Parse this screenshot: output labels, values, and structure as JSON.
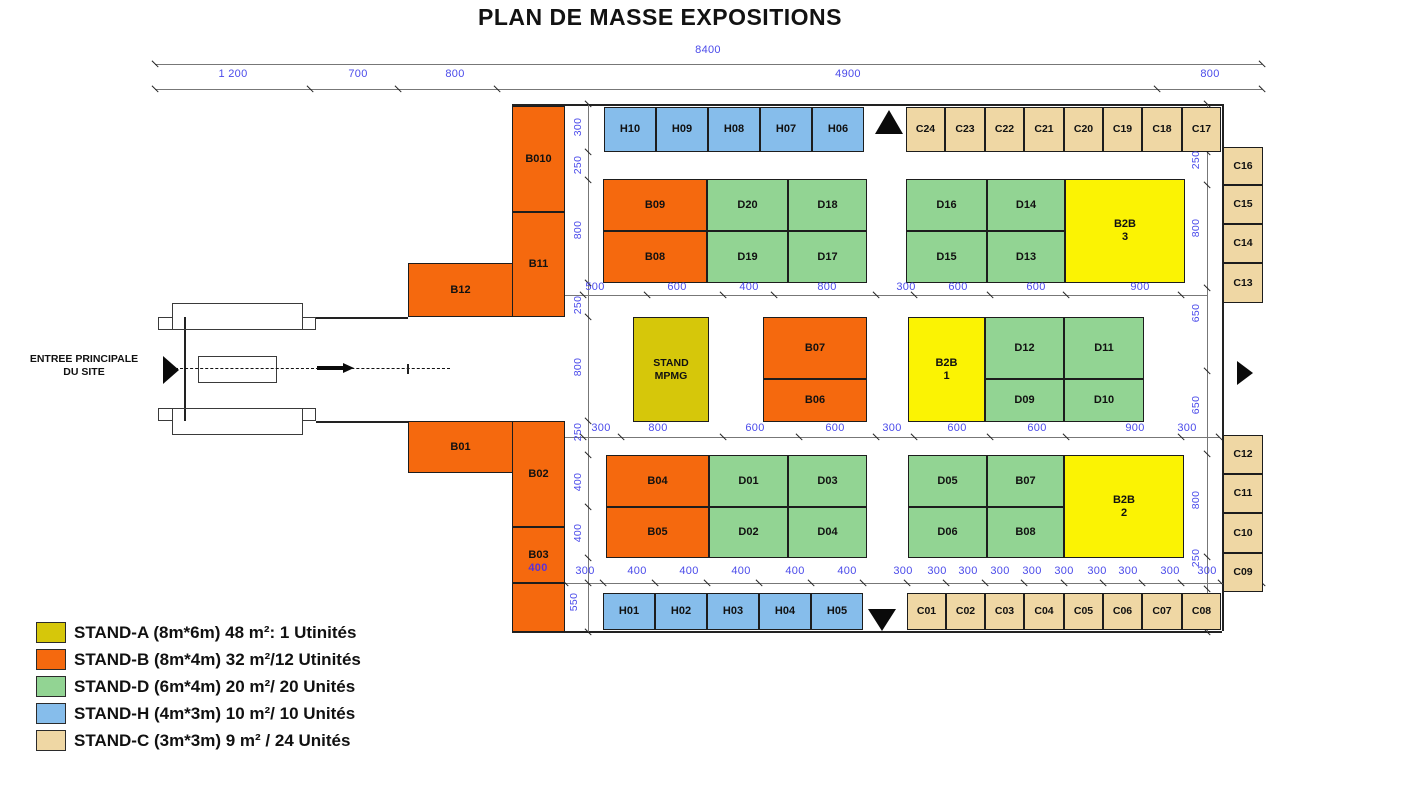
{
  "title": "PLAN DE MASSE EXPOSITIONS",
  "entrance": {
    "line1": "ENTREE PRINCIPALE",
    "line2": "DU SITE"
  },
  "colors": {
    "stand_a_olive": "#D6C70A",
    "stand_b_orange": "#F5690E",
    "stand_d_green": "#92D493",
    "stand_h_blue": "#86BDEB",
    "stand_c_tan": "#EFD7A4",
    "b2b_yellow": "#FBF303",
    "dim_text_blue": "#4B4BEA",
    "dim_text_purple": "#5A31D8",
    "line_dark": "#222222"
  },
  "legend": [
    {
      "type": "a",
      "text": "STAND-A (8m*6m) 48 m²: 1 Utinités"
    },
    {
      "type": "b",
      "text": "STAND-B (8m*4m) 32 m²/12 Utinités"
    },
    {
      "type": "d",
      "text": "STAND-D (6m*4m) 20 m²/ 20 Unités"
    },
    {
      "type": "h",
      "text": "STAND-H (4m*3m) 10 m²/ 10 Unités"
    },
    {
      "type": "c",
      "text": "STAND-C (3m*3m) 9 m² / 24 Unités"
    }
  ],
  "stands": [
    {
      "id": "B010",
      "t": "b",
      "x": 512,
      "y": 106,
      "w": 53,
      "h": 106
    },
    {
      "id": "B11",
      "t": "b",
      "x": 512,
      "y": 212,
      "w": 53,
      "h": 105
    },
    {
      "id": "B12",
      "t": "b",
      "x": 408,
      "y": 263,
      "w": 105,
      "h": 54
    },
    {
      "id": "B01",
      "t": "b",
      "x": 408,
      "y": 421,
      "w": 105,
      "h": 52
    },
    {
      "id": "B02",
      "t": "b",
      "x": 512,
      "y": 421,
      "w": 53,
      "h": 106
    },
    {
      "id": "B03",
      "t": "b",
      "x": 512,
      "y": 527,
      "w": 53,
      "h": 56
    },
    {
      "id": "",
      "n": "b-annex",
      "t": "b",
      "x": 512,
      "y": 583,
      "w": 53,
      "h": 49
    },
    {
      "id": "H10",
      "t": "h",
      "x": 604,
      "y": 107,
      "w": 52,
      "h": 45
    },
    {
      "id": "H09",
      "t": "h",
      "x": 656,
      "y": 107,
      "w": 52,
      "h": 45
    },
    {
      "id": "H08",
      "t": "h",
      "x": 708,
      "y": 107,
      "w": 52,
      "h": 45
    },
    {
      "id": "H07",
      "t": "h",
      "x": 760,
      "y": 107,
      "w": 52,
      "h": 45
    },
    {
      "id": "H06",
      "t": "h",
      "x": 812,
      "y": 107,
      "w": 52,
      "h": 45
    },
    {
      "id": "C24",
      "t": "c",
      "x": 906,
      "y": 107,
      "w": 39,
      "h": 45,
      "fs": 10.5
    },
    {
      "id": "C23",
      "t": "c",
      "x": 945,
      "y": 107,
      "w": 40,
      "h": 45,
      "fs": 10.5
    },
    {
      "id": "C22",
      "t": "c",
      "x": 985,
      "y": 107,
      "w": 39,
      "h": 45,
      "fs": 10.5
    },
    {
      "id": "C21",
      "t": "c",
      "x": 1024,
      "y": 107,
      "w": 40,
      "h": 45,
      "fs": 10.5
    },
    {
      "id": "C20",
      "t": "c",
      "x": 1064,
      "y": 107,
      "w": 39,
      "h": 45,
      "fs": 10.5
    },
    {
      "id": "C19",
      "t": "c",
      "x": 1103,
      "y": 107,
      "w": 39,
      "h": 45,
      "fs": 10.5
    },
    {
      "id": "C18",
      "t": "c",
      "x": 1142,
      "y": 107,
      "w": 40,
      "h": 45,
      "fs": 10.5
    },
    {
      "id": "C17",
      "t": "c",
      "x": 1182,
      "y": 107,
      "w": 39,
      "h": 45,
      "fs": 10.5
    },
    {
      "id": "B09",
      "t": "b",
      "x": 603,
      "y": 179,
      "w": 104,
      "h": 52
    },
    {
      "id": "B08",
      "t": "b",
      "x": 603,
      "y": 231,
      "w": 104,
      "h": 52
    },
    {
      "id": "D20",
      "t": "d",
      "x": 707,
      "y": 179,
      "w": 81,
      "h": 52
    },
    {
      "id": "D18",
      "t": "d",
      "x": 788,
      "y": 179,
      "w": 79,
      "h": 52
    },
    {
      "id": "D19",
      "t": "d",
      "x": 707,
      "y": 231,
      "w": 81,
      "h": 52
    },
    {
      "id": "D17",
      "t": "d",
      "x": 788,
      "y": 231,
      "w": 79,
      "h": 52
    },
    {
      "id": "D16",
      "t": "d",
      "x": 906,
      "y": 179,
      "w": 81,
      "h": 52
    },
    {
      "id": "D14",
      "t": "d",
      "x": 987,
      "y": 179,
      "w": 78,
      "h": 52
    },
    {
      "id": "D15",
      "t": "d",
      "x": 906,
      "y": 231,
      "w": 81,
      "h": 52
    },
    {
      "id": "D13",
      "t": "d",
      "x": 987,
      "y": 231,
      "w": 78,
      "h": 52
    },
    {
      "id": "B2B",
      "id2": "3",
      "n": "b2b-3",
      "t": "y",
      "x": 1065,
      "y": 179,
      "w": 120,
      "h": 104
    },
    {
      "id": "STAND",
      "id2": "MPMG",
      "n": "mpmg",
      "t": "a",
      "x": 633,
      "y": 317,
      "w": 76,
      "h": 105,
      "fs": 10.5
    },
    {
      "id": "B07",
      "t": "b",
      "x": 763,
      "y": 317,
      "w": 104,
      "h": 62
    },
    {
      "id": "B06",
      "t": "b",
      "x": 763,
      "y": 379,
      "w": 104,
      "h": 43
    },
    {
      "id": "B2B",
      "id2": "1",
      "n": "b2b-1",
      "t": "y",
      "x": 908,
      "y": 317,
      "w": 77,
      "h": 105
    },
    {
      "id": "D12",
      "t": "d",
      "x": 985,
      "y": 317,
      "w": 79,
      "h": 62
    },
    {
      "id": "D11",
      "t": "d",
      "x": 1064,
      "y": 317,
      "w": 80,
      "h": 62
    },
    {
      "id": "D09",
      "t": "d",
      "x": 985,
      "y": 379,
      "w": 79,
      "h": 43
    },
    {
      "id": "D10",
      "t": "d",
      "x": 1064,
      "y": 379,
      "w": 80,
      "h": 43
    },
    {
      "id": "B04",
      "t": "b",
      "x": 606,
      "y": 455,
      "w": 103,
      "h": 52
    },
    {
      "id": "B05",
      "t": "b",
      "x": 606,
      "y": 507,
      "w": 103,
      "h": 51
    },
    {
      "id": "D01",
      "t": "d",
      "x": 709,
      "y": 455,
      "w": 79,
      "h": 52
    },
    {
      "id": "D03",
      "t": "d",
      "x": 788,
      "y": 455,
      "w": 79,
      "h": 52
    },
    {
      "id": "D02",
      "t": "d",
      "x": 709,
      "y": 507,
      "w": 79,
      "h": 51
    },
    {
      "id": "D04",
      "t": "d",
      "x": 788,
      "y": 507,
      "w": 79,
      "h": 51
    },
    {
      "id": "D05",
      "t": "d",
      "x": 908,
      "y": 455,
      "w": 79,
      "h": 52
    },
    {
      "id": "B07",
      "n": "b07-d",
      "t": "d",
      "x": 987,
      "y": 455,
      "w": 77,
      "h": 52
    },
    {
      "id": "D06",
      "t": "d",
      "x": 908,
      "y": 507,
      "w": 79,
      "h": 51
    },
    {
      "id": "B08",
      "n": "b08-d",
      "t": "d",
      "x": 987,
      "y": 507,
      "w": 77,
      "h": 51
    },
    {
      "id": "B2B",
      "id2": "2",
      "n": "b2b-2",
      "t": "y",
      "x": 1064,
      "y": 455,
      "w": 120,
      "h": 103
    },
    {
      "id": "H01",
      "t": "h",
      "x": 603,
      "y": 593,
      "w": 52,
      "h": 37
    },
    {
      "id": "H02",
      "t": "h",
      "x": 655,
      "y": 593,
      "w": 52,
      "h": 37
    },
    {
      "id": "H03",
      "t": "h",
      "x": 707,
      "y": 593,
      "w": 52,
      "h": 37
    },
    {
      "id": "H04",
      "t": "h",
      "x": 759,
      "y": 593,
      "w": 52,
      "h": 37
    },
    {
      "id": "H05",
      "t": "h",
      "x": 811,
      "y": 593,
      "w": 52,
      "h": 37
    },
    {
      "id": "C01",
      "t": "c",
      "x": 907,
      "y": 593,
      "w": 39,
      "h": 37,
      "fs": 10.5
    },
    {
      "id": "C02",
      "t": "c",
      "x": 946,
      "y": 593,
      "w": 39,
      "h": 37,
      "fs": 10.5
    },
    {
      "id": "C03",
      "t": "c",
      "x": 985,
      "y": 593,
      "w": 39,
      "h": 37,
      "fs": 10.5
    },
    {
      "id": "C04",
      "t": "c",
      "x": 1024,
      "y": 593,
      "w": 40,
      "h": 37,
      "fs": 10.5
    },
    {
      "id": "C05",
      "t": "c",
      "x": 1064,
      "y": 593,
      "w": 39,
      "h": 37,
      "fs": 10.5
    },
    {
      "id": "C06",
      "t": "c",
      "x": 1103,
      "y": 593,
      "w": 39,
      "h": 37,
      "fs": 10.5
    },
    {
      "id": "C07",
      "t": "c",
      "x": 1142,
      "y": 593,
      "w": 40,
      "h": 37,
      "fs": 10.5
    },
    {
      "id": "C08",
      "t": "c",
      "x": 1182,
      "y": 593,
      "w": 39,
      "h": 37,
      "fs": 10.5
    },
    {
      "id": "C16",
      "t": "c",
      "x": 1223,
      "y": 147,
      "w": 40,
      "h": 38,
      "fs": 10.5
    },
    {
      "id": "C15",
      "t": "c",
      "x": 1223,
      "y": 185,
      "w": 40,
      "h": 39,
      "fs": 10.5
    },
    {
      "id": "C14",
      "t": "c",
      "x": 1223,
      "y": 224,
      "w": 40,
      "h": 39,
      "fs": 10.5
    },
    {
      "id": "C13",
      "t": "c",
      "x": 1223,
      "y": 263,
      "w": 40,
      "h": 40,
      "fs": 10.5
    },
    {
      "id": "C12",
      "t": "c",
      "x": 1223,
      "y": 435,
      "w": 40,
      "h": 39,
      "fs": 10.5
    },
    {
      "id": "C11",
      "t": "c",
      "x": 1223,
      "y": 474,
      "w": 40,
      "h": 39,
      "fs": 10.5
    },
    {
      "id": "C10",
      "t": "c",
      "x": 1223,
      "y": 513,
      "w": 40,
      "h": 40,
      "fs": 10.5
    },
    {
      "id": "C09",
      "t": "c",
      "x": 1223,
      "y": 553,
      "w": 40,
      "h": 39,
      "fs": 10.5
    }
  ],
  "dims_h": [
    {
      "t": "8400",
      "x": 708,
      "y": 50
    },
    {
      "t": "1 200",
      "x": 233,
      "y": 74
    },
    {
      "t": "700",
      "x": 358,
      "y": 74
    },
    {
      "t": "800",
      "x": 455,
      "y": 74
    },
    {
      "t": "4900",
      "x": 848,
      "y": 74
    },
    {
      "t": "800",
      "x": 1210,
      "y": 74
    },
    {
      "t": "500",
      "x": 595,
      "y": 287
    },
    {
      "t": "600",
      "x": 677,
      "y": 287
    },
    {
      "t": "400",
      "x": 749,
      "y": 287
    },
    {
      "t": "800",
      "x": 827,
      "y": 287
    },
    {
      "t": "300",
      "x": 906,
      "y": 287
    },
    {
      "t": "600",
      "x": 958,
      "y": 287
    },
    {
      "t": "600",
      "x": 1036,
      "y": 287
    },
    {
      "t": "900",
      "x": 1140,
      "y": 287
    },
    {
      "t": "300",
      "x": 601,
      "y": 428
    },
    {
      "t": "800",
      "x": 658,
      "y": 428
    },
    {
      "t": "600",
      "x": 755,
      "y": 428
    },
    {
      "t": "600",
      "x": 835,
      "y": 428
    },
    {
      "t": "300",
      "x": 892,
      "y": 428
    },
    {
      "t": "600",
      "x": 957,
      "y": 428
    },
    {
      "t": "600",
      "x": 1037,
      "y": 428
    },
    {
      "t": "900",
      "x": 1135,
      "y": 428
    },
    {
      "t": "300",
      "x": 1187,
      "y": 428
    },
    {
      "t": "400",
      "x": 538,
      "y": 568,
      "c": "#5A31D8"
    },
    {
      "t": "300",
      "x": 585,
      "y": 571
    },
    {
      "t": "400",
      "x": 637,
      "y": 571
    },
    {
      "t": "400",
      "x": 689,
      "y": 571
    },
    {
      "t": "400",
      "x": 741,
      "y": 571
    },
    {
      "t": "400",
      "x": 795,
      "y": 571
    },
    {
      "t": "400",
      "x": 847,
      "y": 571
    },
    {
      "t": "300",
      "x": 903,
      "y": 571
    },
    {
      "t": "300",
      "x": 937,
      "y": 571
    },
    {
      "t": "300",
      "x": 968,
      "y": 571
    },
    {
      "t": "300",
      "x": 1000,
      "y": 571
    },
    {
      "t": "300",
      "x": 1032,
      "y": 571
    },
    {
      "t": "300",
      "x": 1064,
      "y": 571
    },
    {
      "t": "300",
      "x": 1097,
      "y": 571
    },
    {
      "t": "300",
      "x": 1128,
      "y": 571
    },
    {
      "t": "300",
      "x": 1170,
      "y": 571
    },
    {
      "t": "300",
      "x": 1207,
      "y": 571
    }
  ],
  "dims_v": [
    {
      "t": "300",
      "x": 578,
      "y": 127
    },
    {
      "t": "250",
      "x": 578,
      "y": 165
    },
    {
      "t": "800",
      "x": 578,
      "y": 230
    },
    {
      "t": "250",
      "x": 578,
      "y": 305
    },
    {
      "t": "800",
      "x": 578,
      "y": 367
    },
    {
      "t": "250",
      "x": 578,
      "y": 432
    },
    {
      "t": "400",
      "x": 578,
      "y": 482
    },
    {
      "t": "400",
      "x": 578,
      "y": 533
    },
    {
      "t": "550",
      "x": 574,
      "y": 602
    },
    {
      "t": "250",
      "x": 1196,
      "y": 160
    },
    {
      "t": "800",
      "x": 1196,
      "y": 228
    },
    {
      "t": "650",
      "x": 1196,
      "y": 313
    },
    {
      "t": "650",
      "x": 1196,
      "y": 405
    },
    {
      "t": "800",
      "x": 1196,
      "y": 500
    },
    {
      "t": "250",
      "x": 1196,
      "y": 558
    }
  ],
  "lines": {
    "structural": [
      [
        512,
        104,
        710,
        0
      ],
      [
        512,
        631,
        710,
        0
      ],
      [
        1222,
        104,
        0,
        527
      ],
      [
        316,
        317,
        92,
        0
      ],
      [
        316,
        421,
        92,
        0
      ],
      [
        184,
        317,
        0,
        104
      ]
    ],
    "dimension": [
      [
        588,
        104,
        0,
        528
      ],
      [
        1207,
        104,
        0,
        528
      ],
      [
        565,
        295,
        642,
        0
      ],
      [
        565,
        437,
        654,
        0
      ],
      [
        512,
        583,
        750,
        0
      ],
      [
        155,
        64,
        1107,
        0
      ],
      [
        155,
        89,
        1107,
        0
      ]
    ]
  },
  "ticks": [
    [
      155,
      64
    ],
    [
      1262,
      64
    ],
    [
      155,
      89
    ],
    [
      310,
      89
    ],
    [
      398,
      89
    ],
    [
      497,
      89
    ],
    [
      1157,
      89
    ],
    [
      1262,
      89
    ],
    [
      588,
      104
    ],
    [
      588,
      152
    ],
    [
      588,
      180
    ],
    [
      588,
      283
    ],
    [
      588,
      317
    ],
    [
      588,
      421
    ],
    [
      588,
      455
    ],
    [
      588,
      507
    ],
    [
      588,
      558
    ],
    [
      588,
      583
    ],
    [
      588,
      632
    ],
    [
      1207,
      104
    ],
    [
      1207,
      152
    ],
    [
      1207,
      185
    ],
    [
      1207,
      288
    ],
    [
      1207,
      371
    ],
    [
      1207,
      454
    ],
    [
      1207,
      557
    ],
    [
      1207,
      589
    ],
    [
      1207,
      632
    ],
    [
      583,
      295
    ],
    [
      647,
      295
    ],
    [
      723,
      295
    ],
    [
      774,
      295
    ],
    [
      876,
      295
    ],
    [
      914,
      295
    ],
    [
      990,
      295
    ],
    [
      1066,
      295
    ],
    [
      1181,
      295
    ],
    [
      583,
      437
    ],
    [
      621,
      437
    ],
    [
      723,
      437
    ],
    [
      799,
      437
    ],
    [
      876,
      437
    ],
    [
      914,
      437
    ],
    [
      990,
      437
    ],
    [
      1066,
      437
    ],
    [
      1181,
      437
    ],
    [
      1219,
      437
    ],
    [
      565,
      583
    ],
    [
      603,
      583
    ],
    [
      655,
      583
    ],
    [
      707,
      583
    ],
    [
      759,
      583
    ],
    [
      811,
      583
    ],
    [
      863,
      583
    ],
    [
      907,
      583
    ],
    [
      946,
      583
    ],
    [
      985,
      583
    ],
    [
      1024,
      583
    ],
    [
      1064,
      583
    ],
    [
      1103,
      583
    ],
    [
      1142,
      583
    ],
    [
      1181,
      583
    ],
    [
      1221,
      583
    ],
    [
      1262,
      583
    ]
  ],
  "triangles": [
    {
      "dir": "up",
      "x": 875,
      "y": 110,
      "w": 28,
      "h": 24,
      "name": "north-aisle-arrow"
    },
    {
      "dir": "down",
      "x": 868,
      "y": 609,
      "w": 28,
      "h": 22,
      "name": "south-aisle-arrow"
    },
    {
      "dir": "right",
      "x": 1237,
      "y": 361,
      "w": 16,
      "h": 24,
      "name": "east-exit-arrow"
    },
    {
      "dir": "right",
      "x": 163,
      "y": 356,
      "w": 16,
      "h": 28,
      "name": "entrance-arrow"
    }
  ],
  "gate_rects": [
    [
      172,
      303,
      131,
      27
    ],
    [
      158,
      317,
      15,
      13
    ],
    [
      302,
      317,
      14,
      13
    ],
    [
      172,
      408,
      131,
      27
    ],
    [
      158,
      408,
      15,
      13
    ],
    [
      302,
      408,
      14,
      13
    ],
    [
      198,
      356,
      79,
      27
    ]
  ],
  "road": {
    "dash_x": 175,
    "dash_y": 368,
    "dash_w": 275,
    "arrow_x": 317,
    "arrow_y": 366,
    "arrow_w": 26,
    "tick_x": 407
  }
}
